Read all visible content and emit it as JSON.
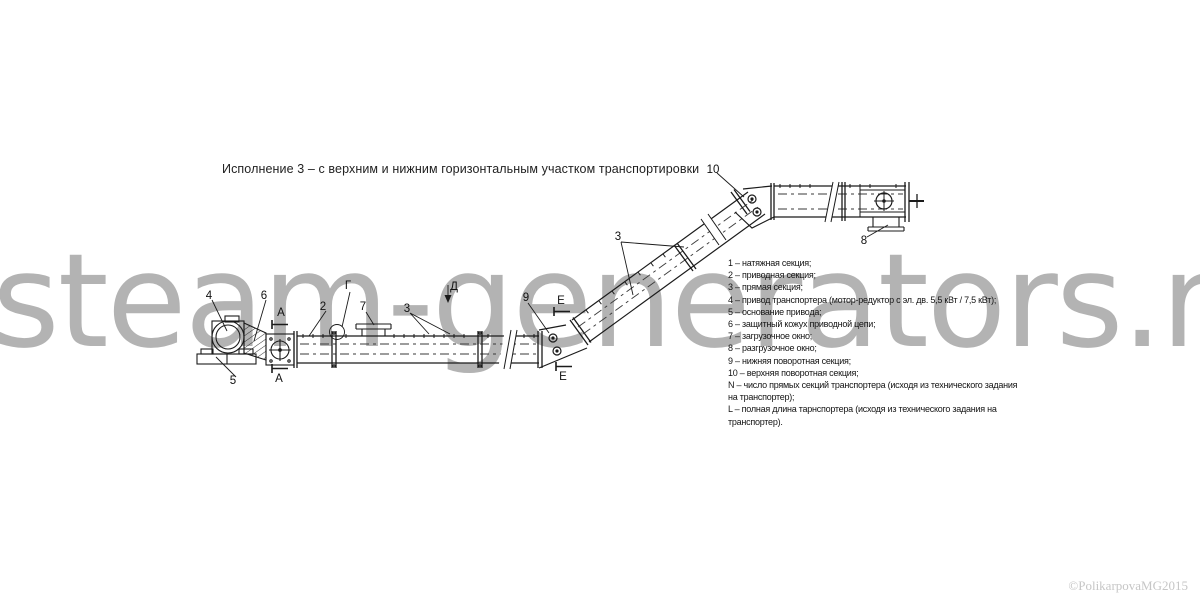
{
  "title": "Исполнение  3 – с верхним и нижним горизонтальным участком транспортировки",
  "watermark": {
    "text": "steam-generators.ru",
    "color": "#b3b3b3"
  },
  "copyright": {
    "text": "©PolikarpovaMG2015"
  },
  "legend": {
    "items": [
      "1 – натяжная секция;",
      "2 – приводная секция;",
      "3 – прямая секция;",
      "4 – привод транспортера (мотор-редуктор с эл. дв. 5,5 кВт / 7,5 кВт);",
      "5 – основание привода;",
      "6 – защитный кожух приводной цепи;",
      "7 – загрузочное окно;",
      "8 – разгрузочное окно;",
      "9 – нижняя поворотная секция;",
      "10 – верхняя поворотная секция;",
      "N – число прямых секций транспортера (исходя из технического задания",
      "на транспортер);",
      "L – полная длина тарнспортера (исходя из технического задания на",
      "транспортер)."
    ]
  },
  "diagram": {
    "description": "Chain conveyor, version 3: lower horizontal run, inclined run, upper horizontal run",
    "callouts": [
      {
        "label": "4",
        "x": 209,
        "y": 296
      },
      {
        "label": "6",
        "x": 264,
        "y": 296
      },
      {
        "label": "5",
        "x": 233,
        "y": 381
      },
      {
        "label": "2",
        "x": 323,
        "y": 307
      },
      {
        "label": "7",
        "x": 363,
        "y": 307
      },
      {
        "label": "Г",
        "x": 348,
        "y": 286
      },
      {
        "label": "А",
        "x": 281,
        "y": 313
      },
      {
        "label": "А",
        "x": 279,
        "y": 379
      },
      {
        "label": "3",
        "x": 407,
        "y": 309
      },
      {
        "label": "Д",
        "x": 454,
        "y": 287
      },
      {
        "label": "9",
        "x": 526,
        "y": 298
      },
      {
        "label": "Е",
        "x": 561,
        "y": 301
      },
      {
        "label": "Е",
        "x": 563,
        "y": 377
      },
      {
        "label": "3",
        "x": 618,
        "y": 237
      },
      {
        "label": "10",
        "x": 713,
        "y": 170
      },
      {
        "label": "8",
        "x": 864,
        "y": 241
      }
    ]
  },
  "colors": {
    "background": "#ffffff",
    "line": "#1b1b1b",
    "watermark": "#b3b3b3",
    "copyright": "#c6c6c6"
  }
}
